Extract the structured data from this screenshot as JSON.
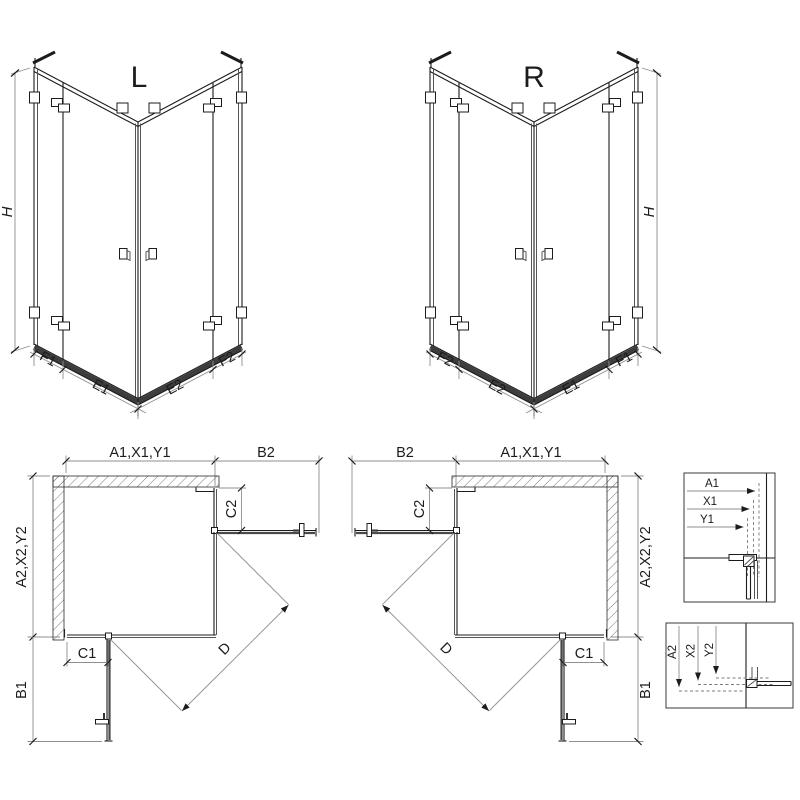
{
  "colors": {
    "line": "#1c1c1c",
    "dim_line": "#8f8f8f",
    "rail_dark": "#3d3d3d",
    "hatch": "#6a6a6a",
    "background": "#ffffff"
  },
  "iso_left": {
    "title": "L",
    "h_label": "H",
    "seg1": "F1",
    "seg2": "E1",
    "seg3": "E2",
    "seg4": "F2"
  },
  "iso_right": {
    "title": "R",
    "h_label": "H",
    "seg1": "F2",
    "seg2": "E2",
    "seg3": "E1",
    "seg4": "F1"
  },
  "plan_left": {
    "top_width": "A1,X1,Y1",
    "door_top": "B2",
    "fixed_top": "C2",
    "depth": "A2,X2,Y2",
    "fixed_bottom": "C1",
    "door_bottom": "B1",
    "diagonal": "D"
  },
  "plan_right": {
    "top_width": "A1,X1,Y1",
    "door_top": "B2",
    "fixed_top": "C2",
    "depth": "A2,X2,Y2",
    "fixed_bottom": "C1",
    "door_bottom": "B1",
    "diagonal": "D"
  },
  "detail_top": {
    "row1": "A1",
    "row2": "X1",
    "row3": "Y1"
  },
  "detail_bottom": {
    "col1": "A2",
    "col2": "X2",
    "col3": "Y2"
  }
}
